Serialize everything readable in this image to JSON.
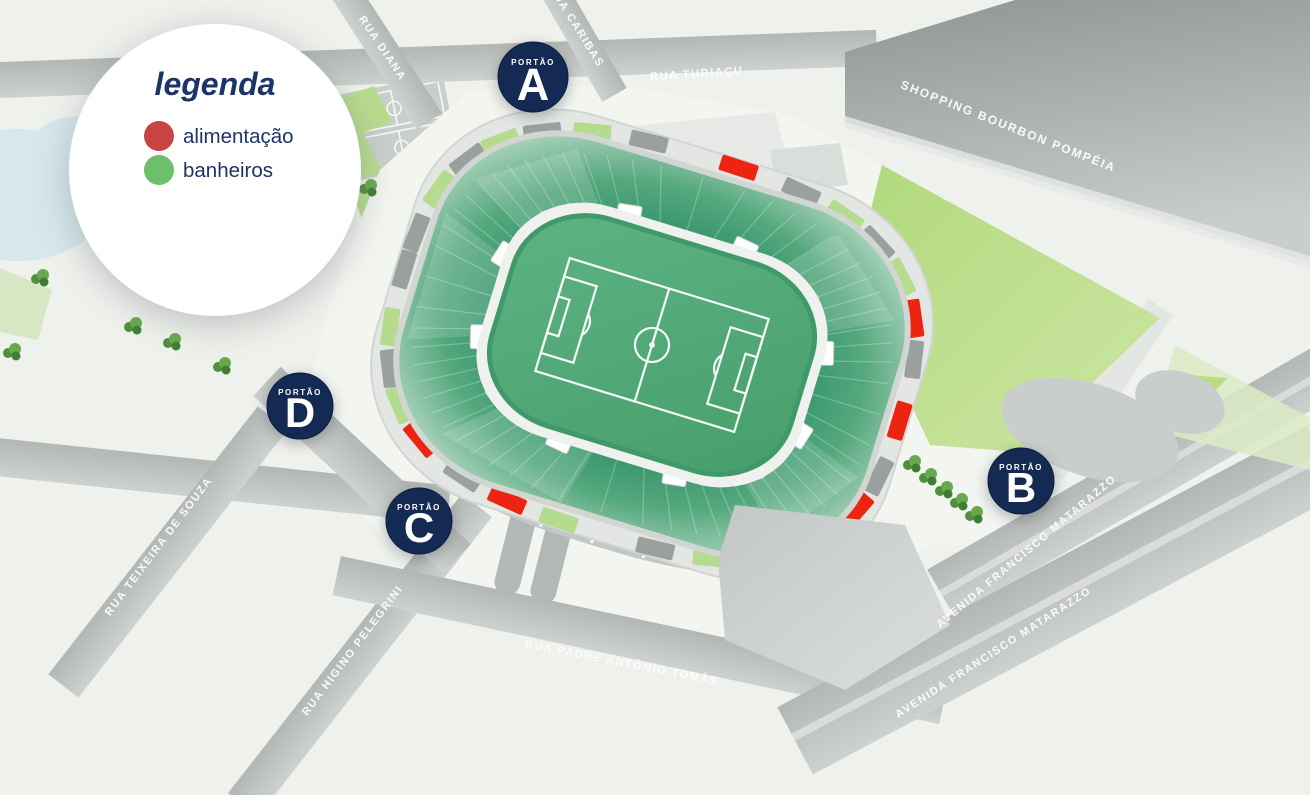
{
  "legend": {
    "title": "legenda",
    "items": [
      {
        "id": "alimentacao",
        "label": "alimentação",
        "color": "#c84341"
      },
      {
        "id": "banheiros",
        "label": "banheiros",
        "color": "#6dbf6a"
      }
    ]
  },
  "gates": {
    "label": "PORTÃO",
    "items": [
      {
        "letter": "A"
      },
      {
        "letter": "D"
      },
      {
        "letter": "C"
      },
      {
        "letter": "B"
      }
    ]
  },
  "streets": {
    "rua_diana": "RUA DIANA",
    "rua_caribas": "RUA CARIBAS",
    "rua_turiacu": "RUA TURIAÇU",
    "shopping": "SHOPPING BOURBON POMPÉIA",
    "rua_teixeira": "RUA TEIXEIRA DE SOUZA",
    "rua_higino": "RUA HIGINO PELEGRINI",
    "rua_padre": "RUA PADRE ANTÔNIO TOMÁS",
    "av_matarazzo": "AVENIDA FRANCISCO MATARAZZO"
  },
  "colors": {
    "background": "#eff1ed",
    "navy_badge": "#142a52",
    "navy_text": "#1c3468",
    "marker_red": "#ee2413",
    "marker_green": "#b4db8e",
    "marker_gray": "#9aa09d",
    "pitch_green": "#52a974",
    "park_green": "#b7dc85",
    "street_gray": "#c0c4c2"
  },
  "stadium": {
    "markers": [
      [
        -174,
        "gray"
      ],
      [
        -161,
        "green"
      ],
      [
        -148,
        "gray"
      ],
      [
        -136,
        "green"
      ],
      [
        -123,
        "gray"
      ],
      [
        -110,
        "green"
      ],
      [
        -98,
        "gray"
      ],
      [
        -87,
        "red"
      ],
      [
        -75,
        "gray"
      ],
      [
        -63,
        "green"
      ],
      [
        -51,
        "gray"
      ],
      [
        -38,
        "green"
      ],
      [
        -24,
        "red"
      ],
      [
        -12,
        "gray"
      ],
      [
        0,
        "red"
      ],
      [
        11,
        "gray"
      ],
      [
        23,
        "red"
      ],
      [
        34,
        "gray"
      ],
      [
        46,
        "green"
      ],
      [
        58,
        "gray"
      ],
      [
        70,
        "green"
      ],
      [
        82,
        "gray"
      ],
      [
        94,
        "green"
      ],
      [
        104,
        "red"
      ],
      [
        116,
        "gray"
      ],
      [
        132,
        "red"
      ],
      [
        145,
        "green"
      ],
      [
        157,
        "gray"
      ],
      [
        169,
        "green"
      ],
      [
        180,
        "gray"
      ]
    ]
  },
  "decor": {
    "trees": [
      [
        40,
        278
      ],
      [
        12,
        352
      ],
      [
        133,
        326
      ],
      [
        172,
        342
      ],
      [
        222,
        366
      ],
      [
        368,
        188
      ],
      [
        912,
        464
      ],
      [
        928,
        477
      ],
      [
        944,
        490
      ],
      [
        959,
        502
      ],
      [
        974,
        515
      ]
    ]
  }
}
